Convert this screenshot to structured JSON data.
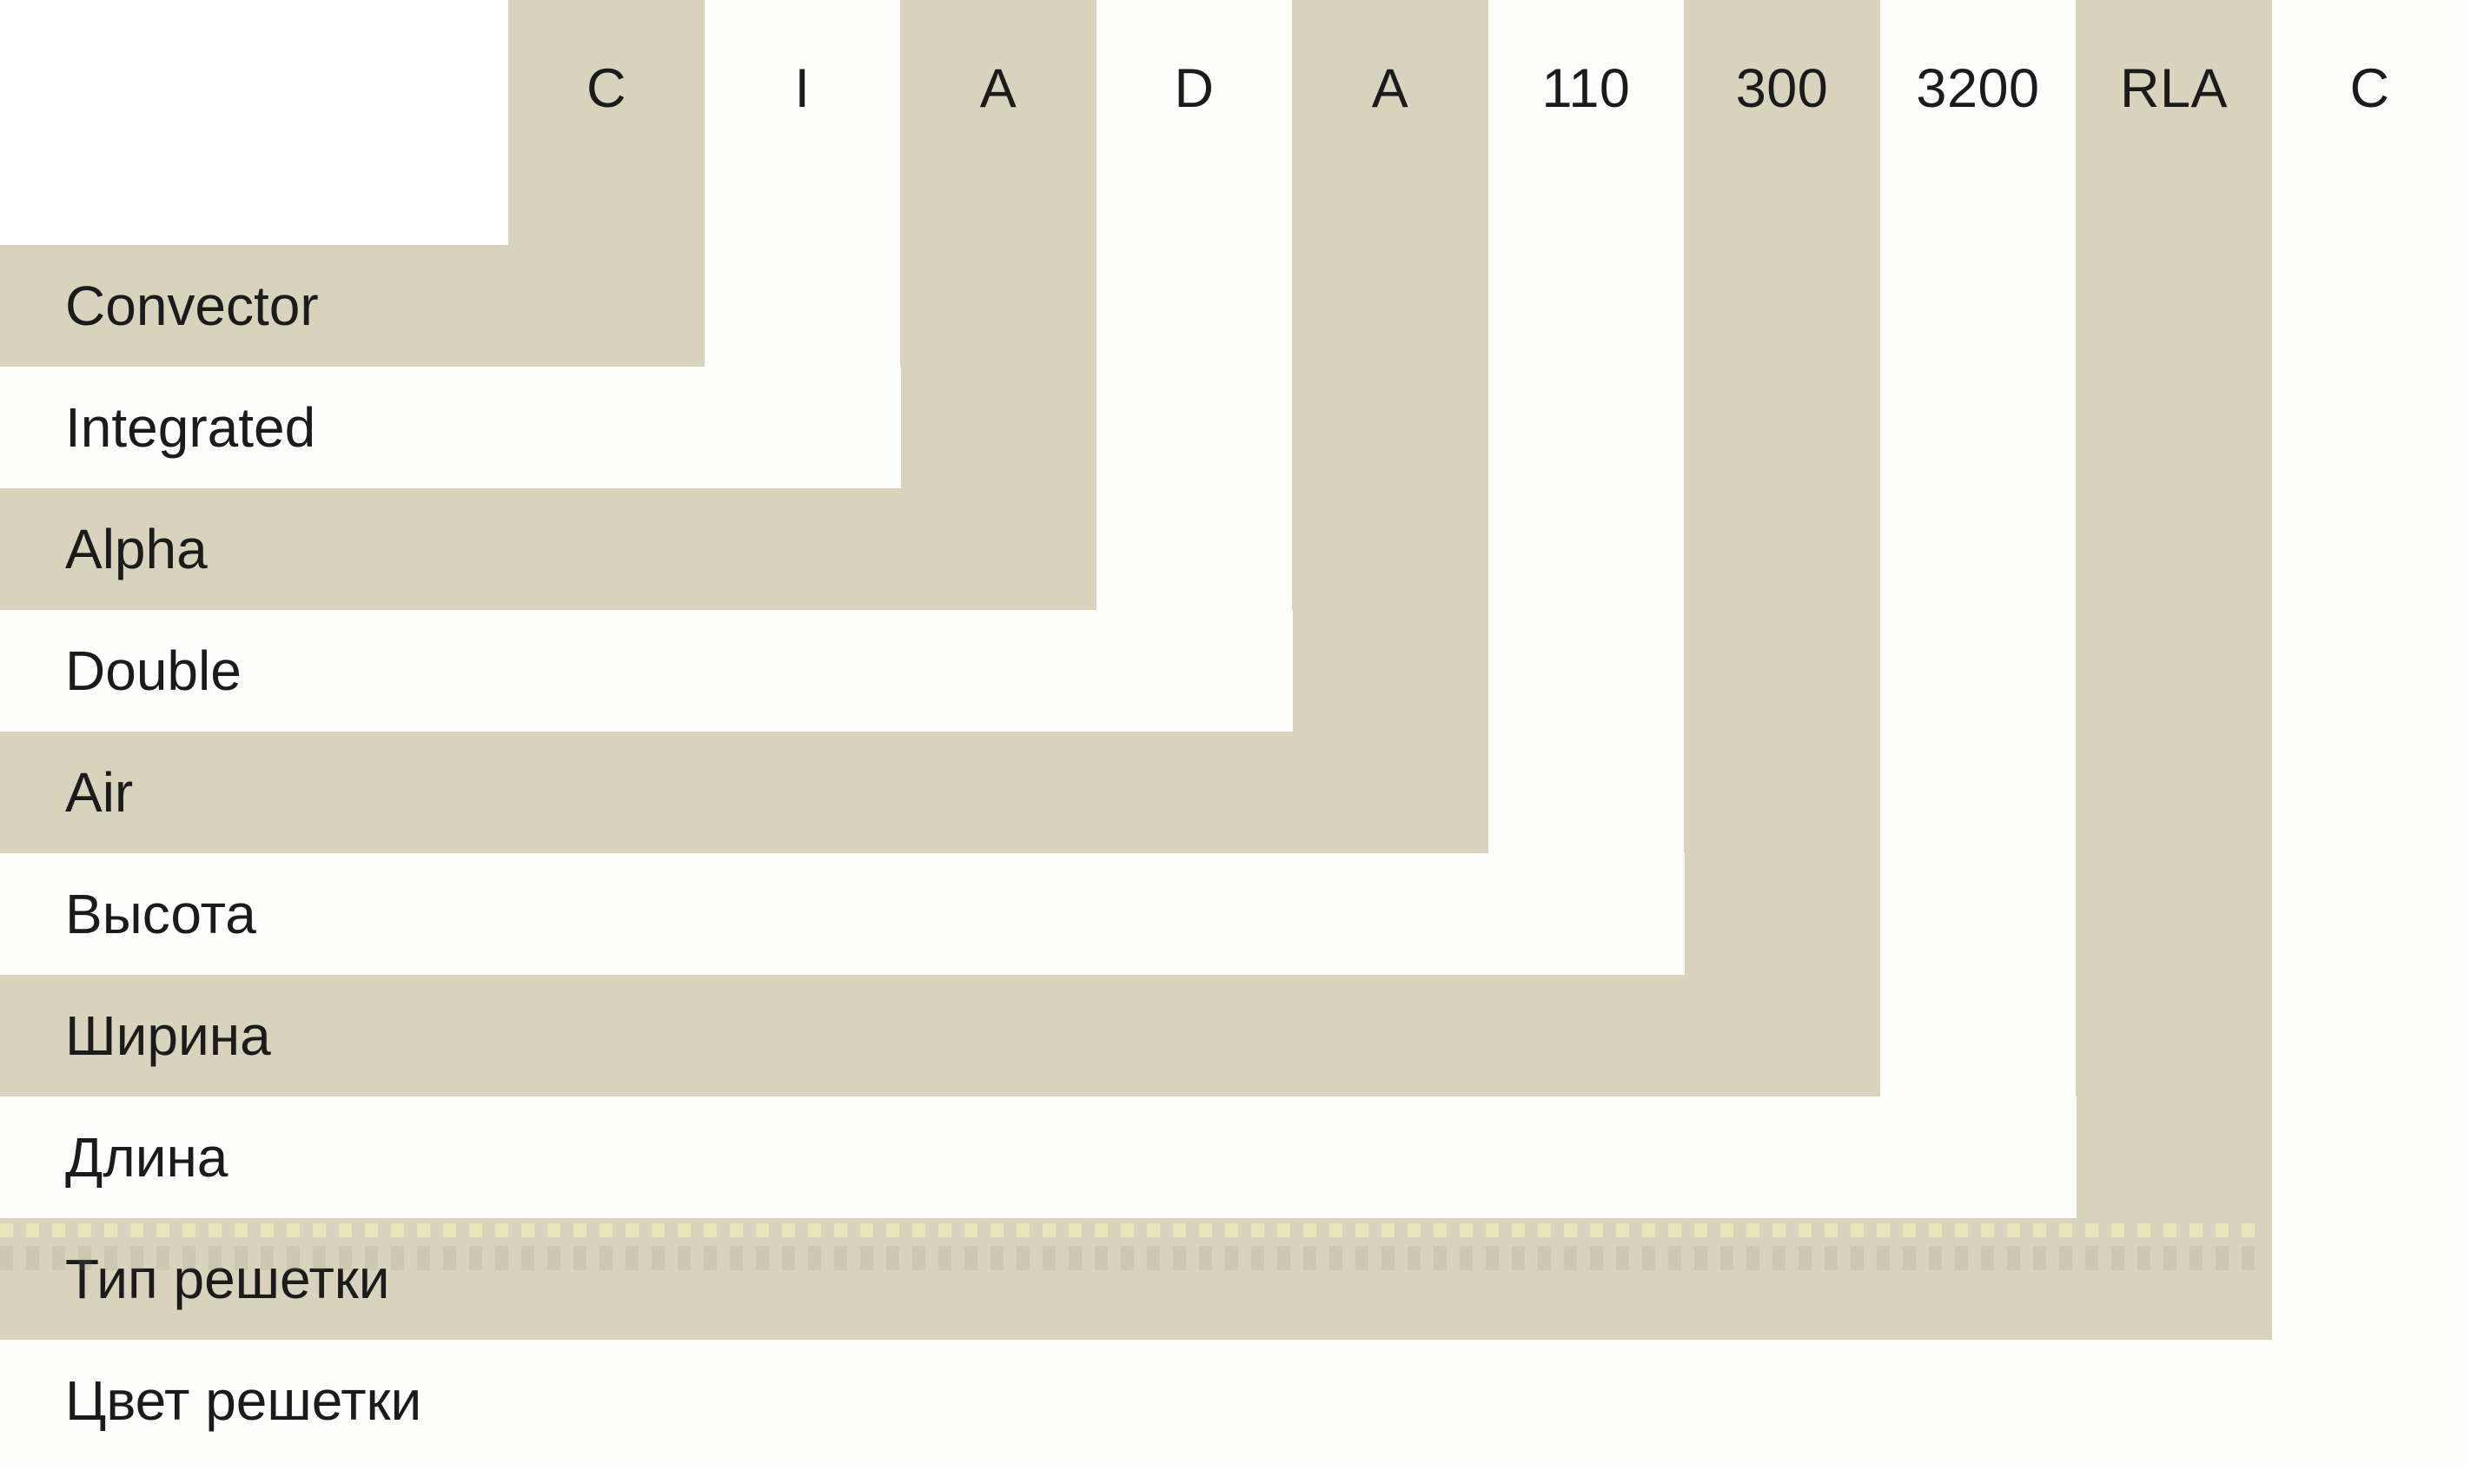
{
  "diagram": {
    "type": "product-nomenclature",
    "items": [
      {
        "code": "C",
        "label": "Convector"
      },
      {
        "code": "I",
        "label": "Integrated"
      },
      {
        "code": "A",
        "label": "Alpha"
      },
      {
        "code": "D",
        "label": "Double"
      },
      {
        "code": "A",
        "label": "Air"
      },
      {
        "code": "110",
        "label": "Высота"
      },
      {
        "code": "300",
        "label": "Ширина"
      },
      {
        "code": "3200",
        "label": "Длина"
      },
      {
        "code": "RLA",
        "label": "Тип решетки"
      },
      {
        "code": "C",
        "label": "Цвет решетки"
      }
    ],
    "colors": {
      "band_beige": "#d7d3bd",
      "band_white": "#fdfdfc",
      "text": "#1b1b1b",
      "background": "#ffffff"
    }
  }
}
